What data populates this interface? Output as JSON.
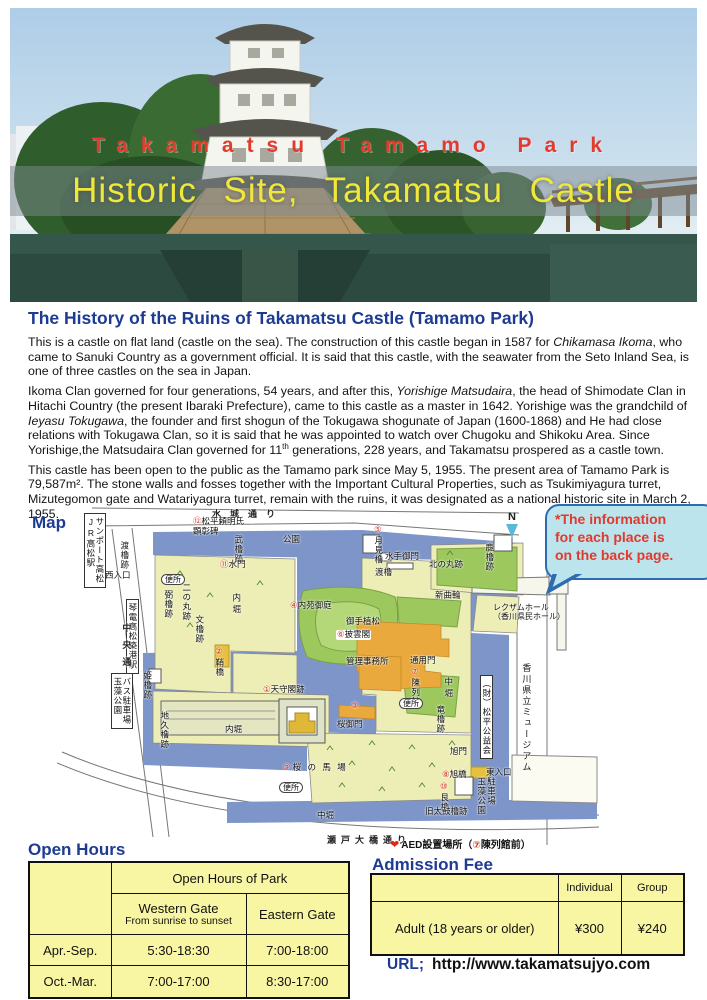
{
  "hero": {
    "supertitle": "Takamatsu Tamamo Park",
    "title": "Historic Site, Takamatsu Castle",
    "supertitle_color": "#e23a2c",
    "title_color": "#efe73a"
  },
  "history": {
    "heading": "The History of the Ruins of Takamatsu Castle (Tamamo Park)",
    "paragraphs": [
      [
        {
          "text": "This is a castle on flat land (castle on the sea). The construction of this castle began in 1587 for ",
          "style": "normal"
        },
        {
          "text": "Chikamasa Ikoma",
          "style": "italic"
        },
        {
          "text": ", who came to Sanuki Country as a government official. It is said that this castle, with the seawater from the Seto Inland Sea, is one of three castles on the sea in Japan.",
          "style": "normal"
        }
      ],
      [
        {
          "text": "Ikoma Clan governed for four generations, 54 years, and after this, ",
          "style": "normal"
        },
        {
          "text": "Yorishige Matsudaira",
          "style": "italic"
        },
        {
          "text": ", the head of Shimodate Clan in Hitachi Country (the present Ibaraki Prefecture), came to this castle as a master in 1642. Yorishige was the grandchild of ",
          "style": "normal"
        },
        {
          "text": "Ieyasu Tokugawa",
          "style": "italic"
        },
        {
          "text": ", the founder and first shogun of the Tokugawa shogunate of Japan (1600-1868) and He had close relations with Tokugawa Clan, so it is said that he was appointed to watch over Chugoku and Shikoku Area. Since Yorishige,the Matsudaira Clan governed for 11",
          "style": "normal"
        },
        {
          "text": "th",
          "style": "sup"
        },
        {
          "text": " generations, 228 years, and Takamatsu prospered as a castle town.",
          "style": "normal"
        }
      ],
      [
        {
          "text": "This castle has been open to the public as the Tamamo park since May 5, 1955. The present area of Tamamo Park is 79,587m². The stone walls and fosses together with the Important Cultural Properties, such as Tsukimiyagura turret, Mizutegomon gate and Watariyagura turret, remain with the ruins, it was designated as a national historic site in March 2, 1955.",
          "style": "normal"
        }
      ]
    ]
  },
  "map": {
    "heading_label": "Map",
    "note": "*The information\nfor each place is\non the back page.",
    "note_color": "#e0392e",
    "compass_label": "N",
    "colors": {
      "water": "#7d95c8",
      "land": "#edeeb6",
      "garden": "#9dc85e",
      "building": "#e9a93c"
    },
    "labels": [
      {
        "text": "水城通り",
        "x": 155,
        "y": 4,
        "dir": "h",
        "kind": "street",
        "ls": 9
      },
      {
        "text": "公園",
        "x": 226,
        "y": 30,
        "dir": "h"
      },
      {
        "text": "武櫓跡",
        "x": 176,
        "y": 30,
        "dir": "v"
      },
      {
        "text": "⑪水門",
        "x": 163,
        "y": 55,
        "dir": "h"
      },
      {
        "text": "⑫松平頼明氏\n顕彰碑",
        "x": 136,
        "y": 12,
        "dir": "h"
      },
      {
        "text": "渡櫓跡",
        "x": 62,
        "y": 36,
        "dir": "v"
      },
      {
        "text": "西入口",
        "x": 48,
        "y": 66,
        "dir": "h"
      },
      {
        "text": "便所",
        "x": 104,
        "y": 69,
        "dir": "h",
        "kind": "oval"
      },
      {
        "text": "二の丸跡",
        "x": 124,
        "y": 78,
        "dir": "v"
      },
      {
        "text": "弼櫓跡",
        "x": 106,
        "y": 85,
        "dir": "v"
      },
      {
        "text": "文櫓跡",
        "x": 137,
        "y": 110,
        "dir": "v"
      },
      {
        "text": "サンポート高松\nJR高松駅",
        "x": 27,
        "y": 8,
        "dir": "v",
        "kind": "box"
      },
      {
        "text": "琴電高松築港駅",
        "x": 69,
        "y": 94,
        "dir": "v",
        "kind": "box"
      },
      {
        "text": "中央通り",
        "x": 64,
        "y": 118,
        "dir": "v",
        "kind": "street",
        "ls": 8
      },
      {
        "text": "バス駐車場\n玉藻公園",
        "x": 54,
        "y": 168,
        "dir": "v",
        "kind": "box"
      },
      {
        "text": "姫櫓跡",
        "x": 85,
        "y": 166,
        "dir": "v"
      },
      {
        "text": "地久櫓跡",
        "x": 102,
        "y": 206,
        "dir": "v"
      },
      {
        "text": "内堀",
        "x": 174,
        "y": 88,
        "dir": "v",
        "ls": 3
      },
      {
        "text": "内堀",
        "x": 168,
        "y": 220,
        "dir": "h"
      },
      {
        "text": "②鞘橋",
        "x": 157,
        "y": 142,
        "dir": "v"
      },
      {
        "text": "①天守閣跡",
        "x": 206,
        "y": 180,
        "dir": "h"
      },
      {
        "text": "④内苑御庭",
        "x": 233,
        "y": 96,
        "dir": "h"
      },
      {
        "text": "御手植松",
        "x": 289,
        "y": 112,
        "dir": "h"
      },
      {
        "text": "⑥披雲閣",
        "x": 279,
        "y": 125,
        "dir": "h",
        "kind": "tag"
      },
      {
        "text": "管理事務所",
        "x": 289,
        "y": 152,
        "dir": "h"
      },
      {
        "text": "⑤月見櫓",
        "x": 316,
        "y": 20,
        "dir": "v"
      },
      {
        "text": "水手御門",
        "x": 328,
        "y": 47,
        "dir": "h"
      },
      {
        "text": "渡櫓",
        "x": 318,
        "y": 63,
        "dir": "h"
      },
      {
        "text": "北の丸跡",
        "x": 372,
        "y": 55,
        "dir": "h"
      },
      {
        "text": "鹿櫓跡",
        "x": 427,
        "y": 38,
        "dir": "v"
      },
      {
        "text": "新曲輪",
        "x": 378,
        "y": 86,
        "dir": "h"
      },
      {
        "text": "長櫓跡",
        "x": 490,
        "y": 62,
        "dir": "h"
      },
      {
        "text": "レクザムホール\n（香川県民ホール）",
        "x": 436,
        "y": 98,
        "dir": "h",
        "fs": 8
      },
      {
        "text": "通用門",
        "x": 353,
        "y": 151,
        "dir": "h"
      },
      {
        "text": "⑦陳列館",
        "x": 353,
        "y": 162,
        "dir": "v"
      },
      {
        "text": "便所",
        "x": 342,
        "y": 193,
        "dir": "h",
        "kind": "oval"
      },
      {
        "text": "中堀",
        "x": 386,
        "y": 172,
        "dir": "v",
        "ls": 3
      },
      {
        "text": "竜櫓跡",
        "x": 378,
        "y": 200,
        "dir": "v"
      },
      {
        "text": "（財）松平公益会",
        "x": 423,
        "y": 170,
        "dir": "v",
        "kind": "box"
      },
      {
        "text": "香川県立ミュージアム",
        "x": 464,
        "y": 158,
        "dir": "v",
        "fs": 9,
        "ls": 2
      },
      {
        "text": "③",
        "x": 294,
        "y": 196,
        "dir": "h"
      },
      {
        "text": "桜御門",
        "x": 280,
        "y": 215,
        "dir": "h"
      },
      {
        "text": "⑨桜 の 馬 場",
        "x": 226,
        "y": 258,
        "dir": "h",
        "ls": 2
      },
      {
        "text": "便所",
        "x": 222,
        "y": 277,
        "dir": "h",
        "kind": "oval"
      },
      {
        "text": "旭門",
        "x": 393,
        "y": 242,
        "dir": "h"
      },
      {
        "text": "⑧旭橋",
        "x": 385,
        "y": 265,
        "dir": "h"
      },
      {
        "text": "東入口",
        "x": 429,
        "y": 263,
        "dir": "h"
      },
      {
        "text": "⑩艮櫓",
        "x": 382,
        "y": 277,
        "dir": "v"
      },
      {
        "text": "旧太鼓櫓跡",
        "x": 368,
        "y": 302,
        "dir": "h"
      },
      {
        "text": "駐車場\n玉藻公園",
        "x": 419,
        "y": 272,
        "dir": "v"
      },
      {
        "text": "中堀",
        "x": 260,
        "y": 306,
        "dir": "h"
      },
      {
        "text": "瀬戸大橋通り",
        "x": 270,
        "y": 330,
        "dir": "h",
        "kind": "street",
        "ls": 5
      },
      {
        "text": "AED設置場所（⑦陳列館前）",
        "x": 333,
        "y": 334,
        "dir": "h",
        "icon": "heart",
        "fs": 10,
        "kind": "legend"
      }
    ]
  },
  "tables": {
    "open_hours": {
      "title": "Open Hours",
      "span_header": "Open Hours of Park",
      "col_west_line1": "Western Gate",
      "col_west_line2": "From sunrise to sunset",
      "col_east": "Eastern Gate",
      "rows": [
        {
          "label": "Apr.-Sep.",
          "western": "5:30-18:30",
          "eastern": "7:00-18:00"
        },
        {
          "label": "Oct.-Mar.",
          "western": "7:00-17:00",
          "eastern": "8:30-17:00"
        }
      ]
    },
    "admission": {
      "title": "Admission Fee",
      "col_individual": "Individual",
      "col_group": "Group",
      "row_label": "Adult (18 years or older)",
      "individual": "¥300",
      "group": "¥240"
    }
  },
  "url": {
    "label": "URL;",
    "value": "http://www.takamatsujyo.com"
  }
}
